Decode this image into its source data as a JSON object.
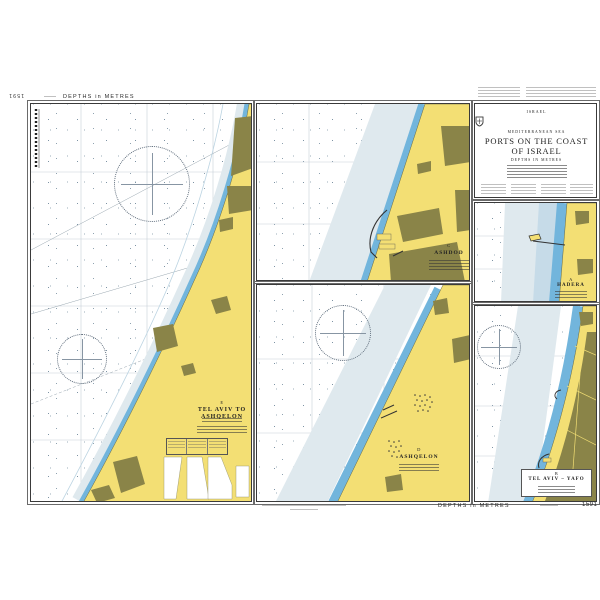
{
  "chart_number": "1591",
  "margins": {
    "top": {
      "chart_number": "1591",
      "depths": "DEPTHS in METRES"
    },
    "bottom": {
      "depths": "DEPTHS in METRES",
      "chart_number": "1591"
    }
  },
  "title_block": {
    "country": "ISRAEL",
    "sea": "MEDITERRANEAN SEA",
    "title1": "PORTS ON THE COAST",
    "title2": "OF ISRAEL",
    "depths": "DEPTHS IN METRES"
  },
  "panels": {
    "main": {
      "letter": "E",
      "title": "TEL AVIV TO ASHQELON"
    },
    "ashdod": {
      "letter": "C",
      "title": "ASHDOD"
    },
    "ashqelon": {
      "letter": "D",
      "title": "ASHQELON"
    },
    "hadera": {
      "letter": "A",
      "title": "HADERA"
    },
    "telaviv": {
      "letter": "B",
      "title": "TEL AVIV – YAFO"
    }
  },
  "colors": {
    "land": "#f3df74",
    "urban": "#8a8448",
    "coastal_blue": "#72b5dc",
    "shallow": "#dfe9ee",
    "light_blue": "#c6dbe8"
  }
}
